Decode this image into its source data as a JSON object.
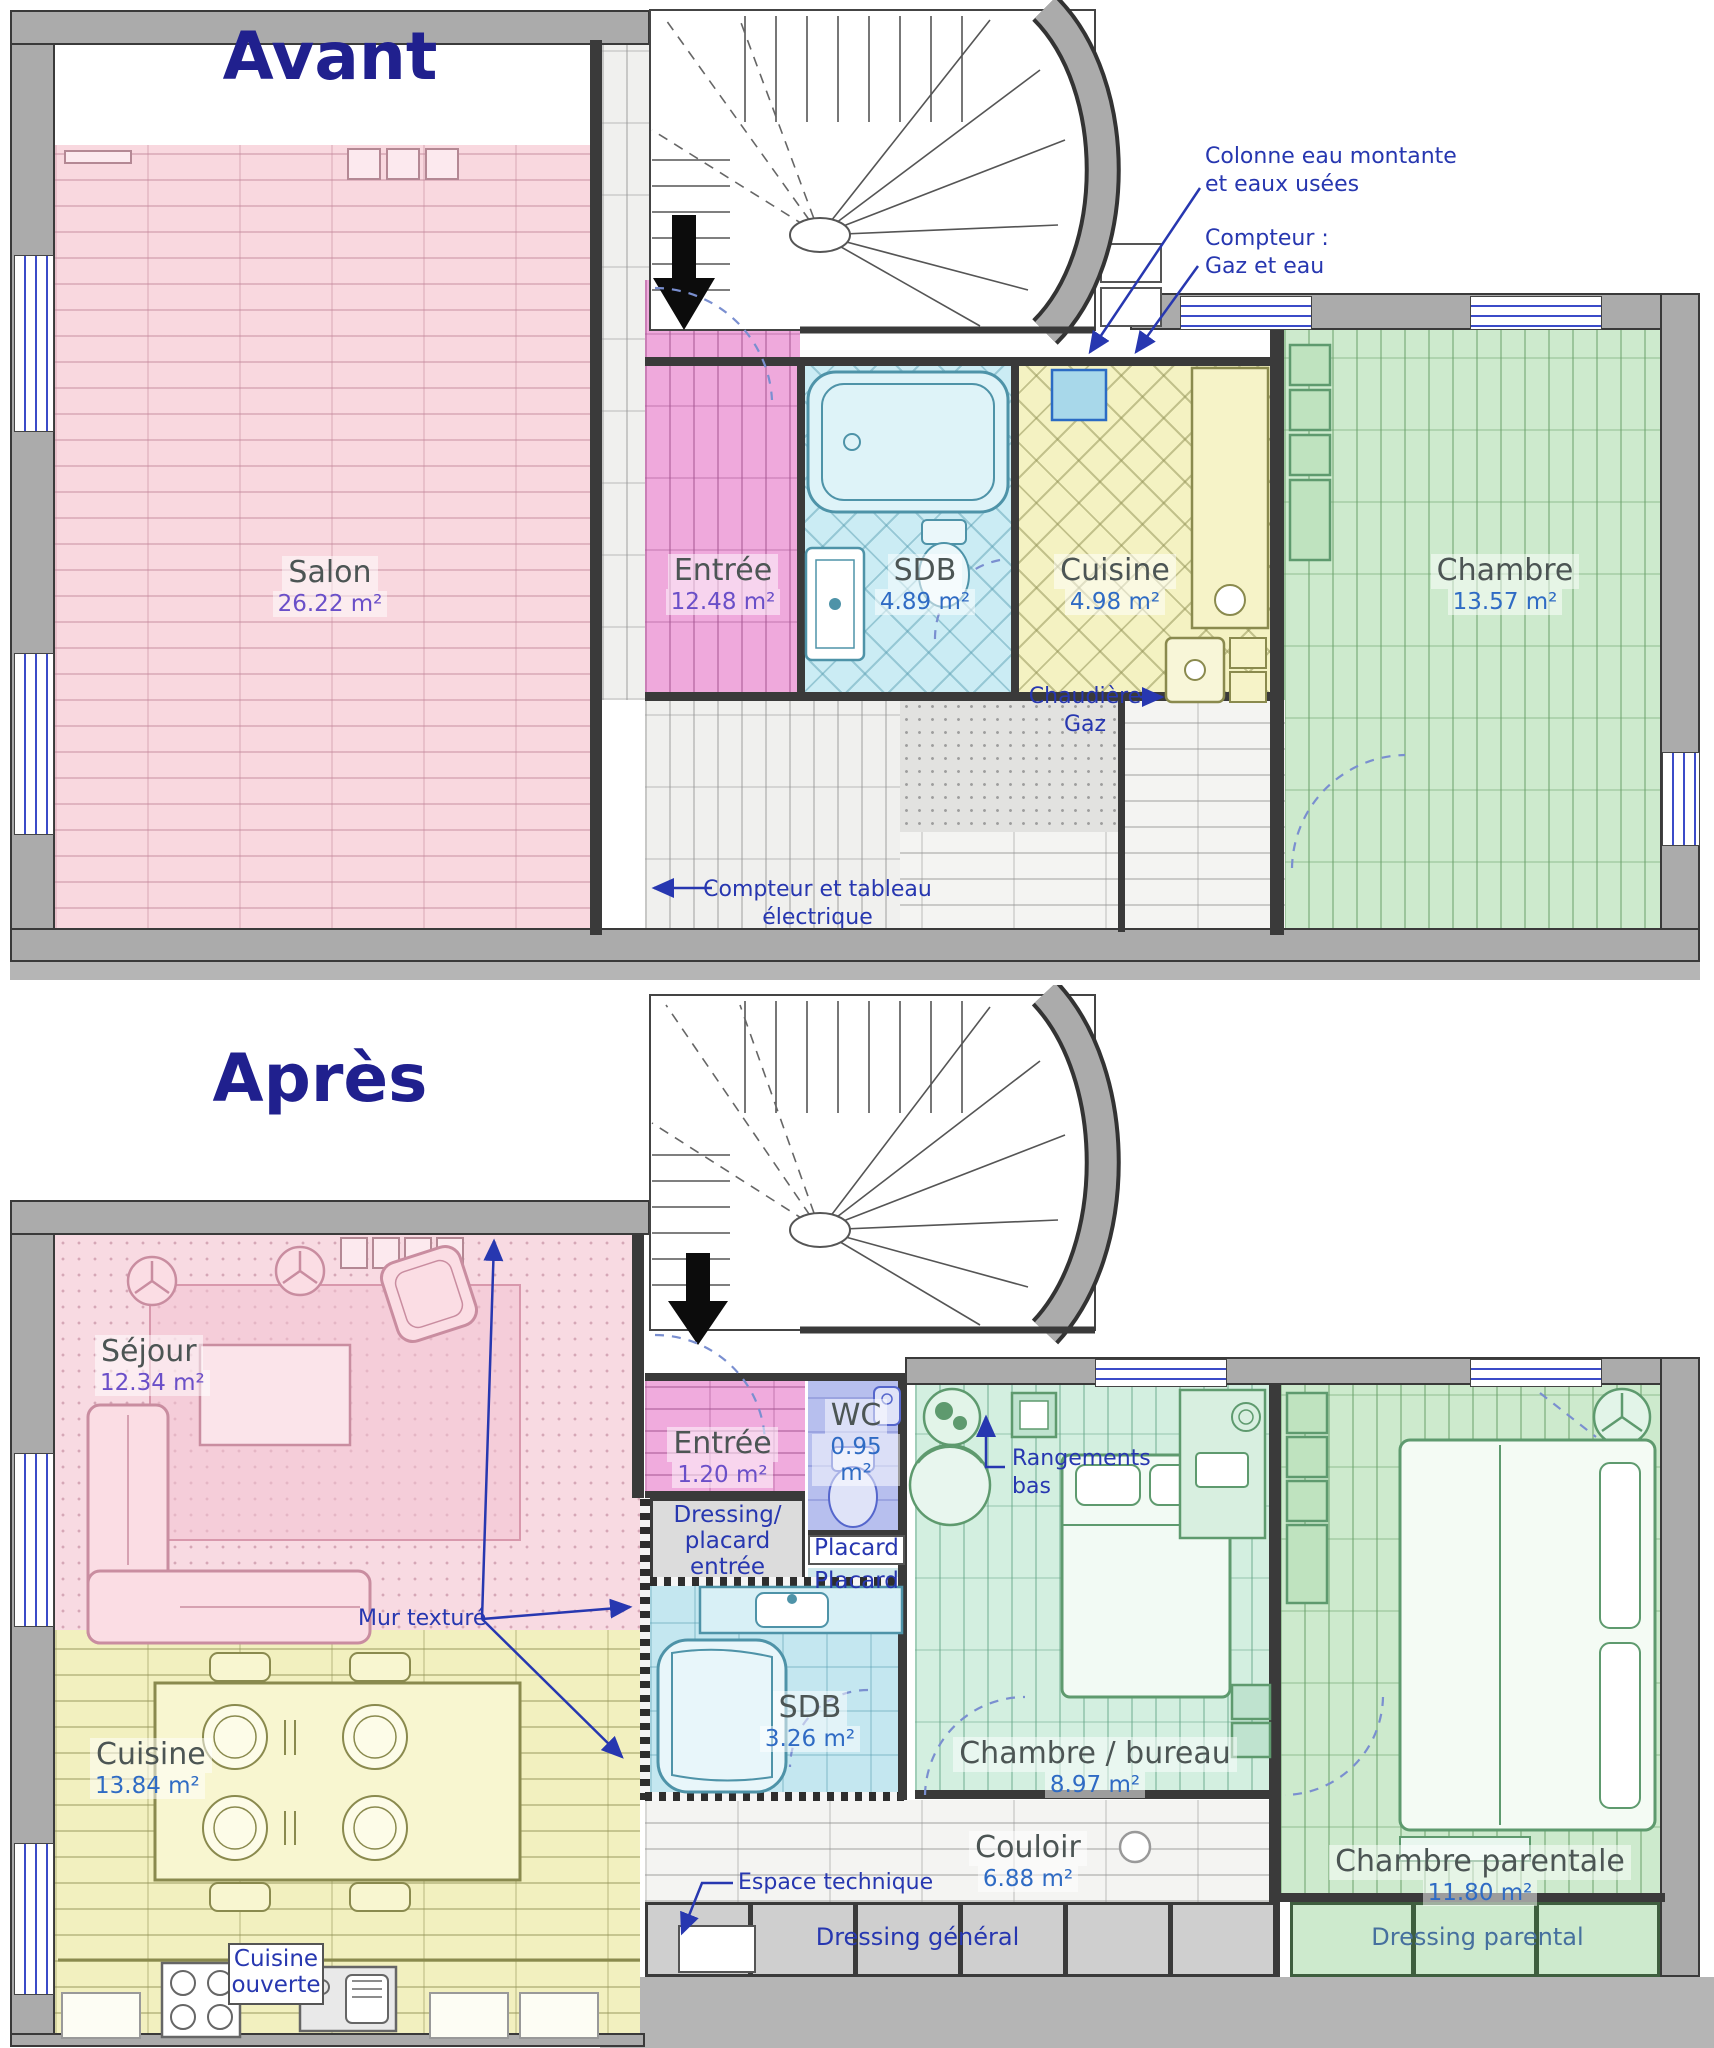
{
  "palette": {
    "title_color": "#20208e",
    "annotation_color": "#2737b0",
    "area_purple": "#6a4fc8",
    "area_blue": "#2f6bc4",
    "salon_pink": "#f9d8df",
    "entree_magenta": "#efa9dc",
    "sdb_cyan": "#cbecf4",
    "cuisine_yellow": "#f4f2c2",
    "chambre_green": "#cdeacd",
    "wc_blue": "#b7bfee",
    "mint_green": "#d3efe0",
    "wall_gray": "#ababab"
  },
  "avant": {
    "title": "Avant",
    "rooms": {
      "salon": {
        "name": "Salon",
        "area": "26.22 m²"
      },
      "entree": {
        "name": "Entrée",
        "area": "12.48 m²"
      },
      "sdb": {
        "name": "SDB",
        "area": "4.89 m²"
      },
      "cuisine": {
        "name": "Cuisine",
        "area": "4.98 m²"
      },
      "chambre": {
        "name": "Chambre",
        "area": "13.57 m²"
      }
    },
    "annotations": {
      "colonne": "Colonne eau montante\net eaux usées",
      "compteur_gaz_eau": "Compteur :\nGaz et eau",
      "chaudiere": "Chaudière\nGaz",
      "compteur_elec": "Compteur et tableau\nélectrique"
    }
  },
  "apres": {
    "title": "Après",
    "rooms": {
      "sejour": {
        "name": "Séjour",
        "area": "12.34 m²"
      },
      "entree": {
        "name": "Entrée",
        "area": "1.20 m²"
      },
      "wc": {
        "name": "WC",
        "area": "0.95 m²"
      },
      "sdb": {
        "name": "SDB",
        "area": "3.26 m²"
      },
      "chambre_bureau": {
        "name": "Chambre / bureau",
        "area": "8.97 m²"
      },
      "cuisine": {
        "name": "Cuisine",
        "area": "13.84 m²"
      },
      "couloir": {
        "name": "Couloir",
        "area": "6.88 m²"
      },
      "chambre_parentale": {
        "name": "Chambre parentale",
        "area": "11.80 m²"
      }
    },
    "storage": {
      "dressing_placard_entree": "Dressing/\nplacard\nentrée",
      "placard_1": "Placard",
      "placard_2": "Placard",
      "dressing_general": "Dressing général",
      "dressing_parental": "Dressing parental",
      "cuisine_ouverte": "Cuisine\nouverte"
    },
    "annotations": {
      "rangements_bas": "Rangements\nbas",
      "mur_texture": "Mur texturé",
      "espace_technique": "Espace technique"
    }
  }
}
